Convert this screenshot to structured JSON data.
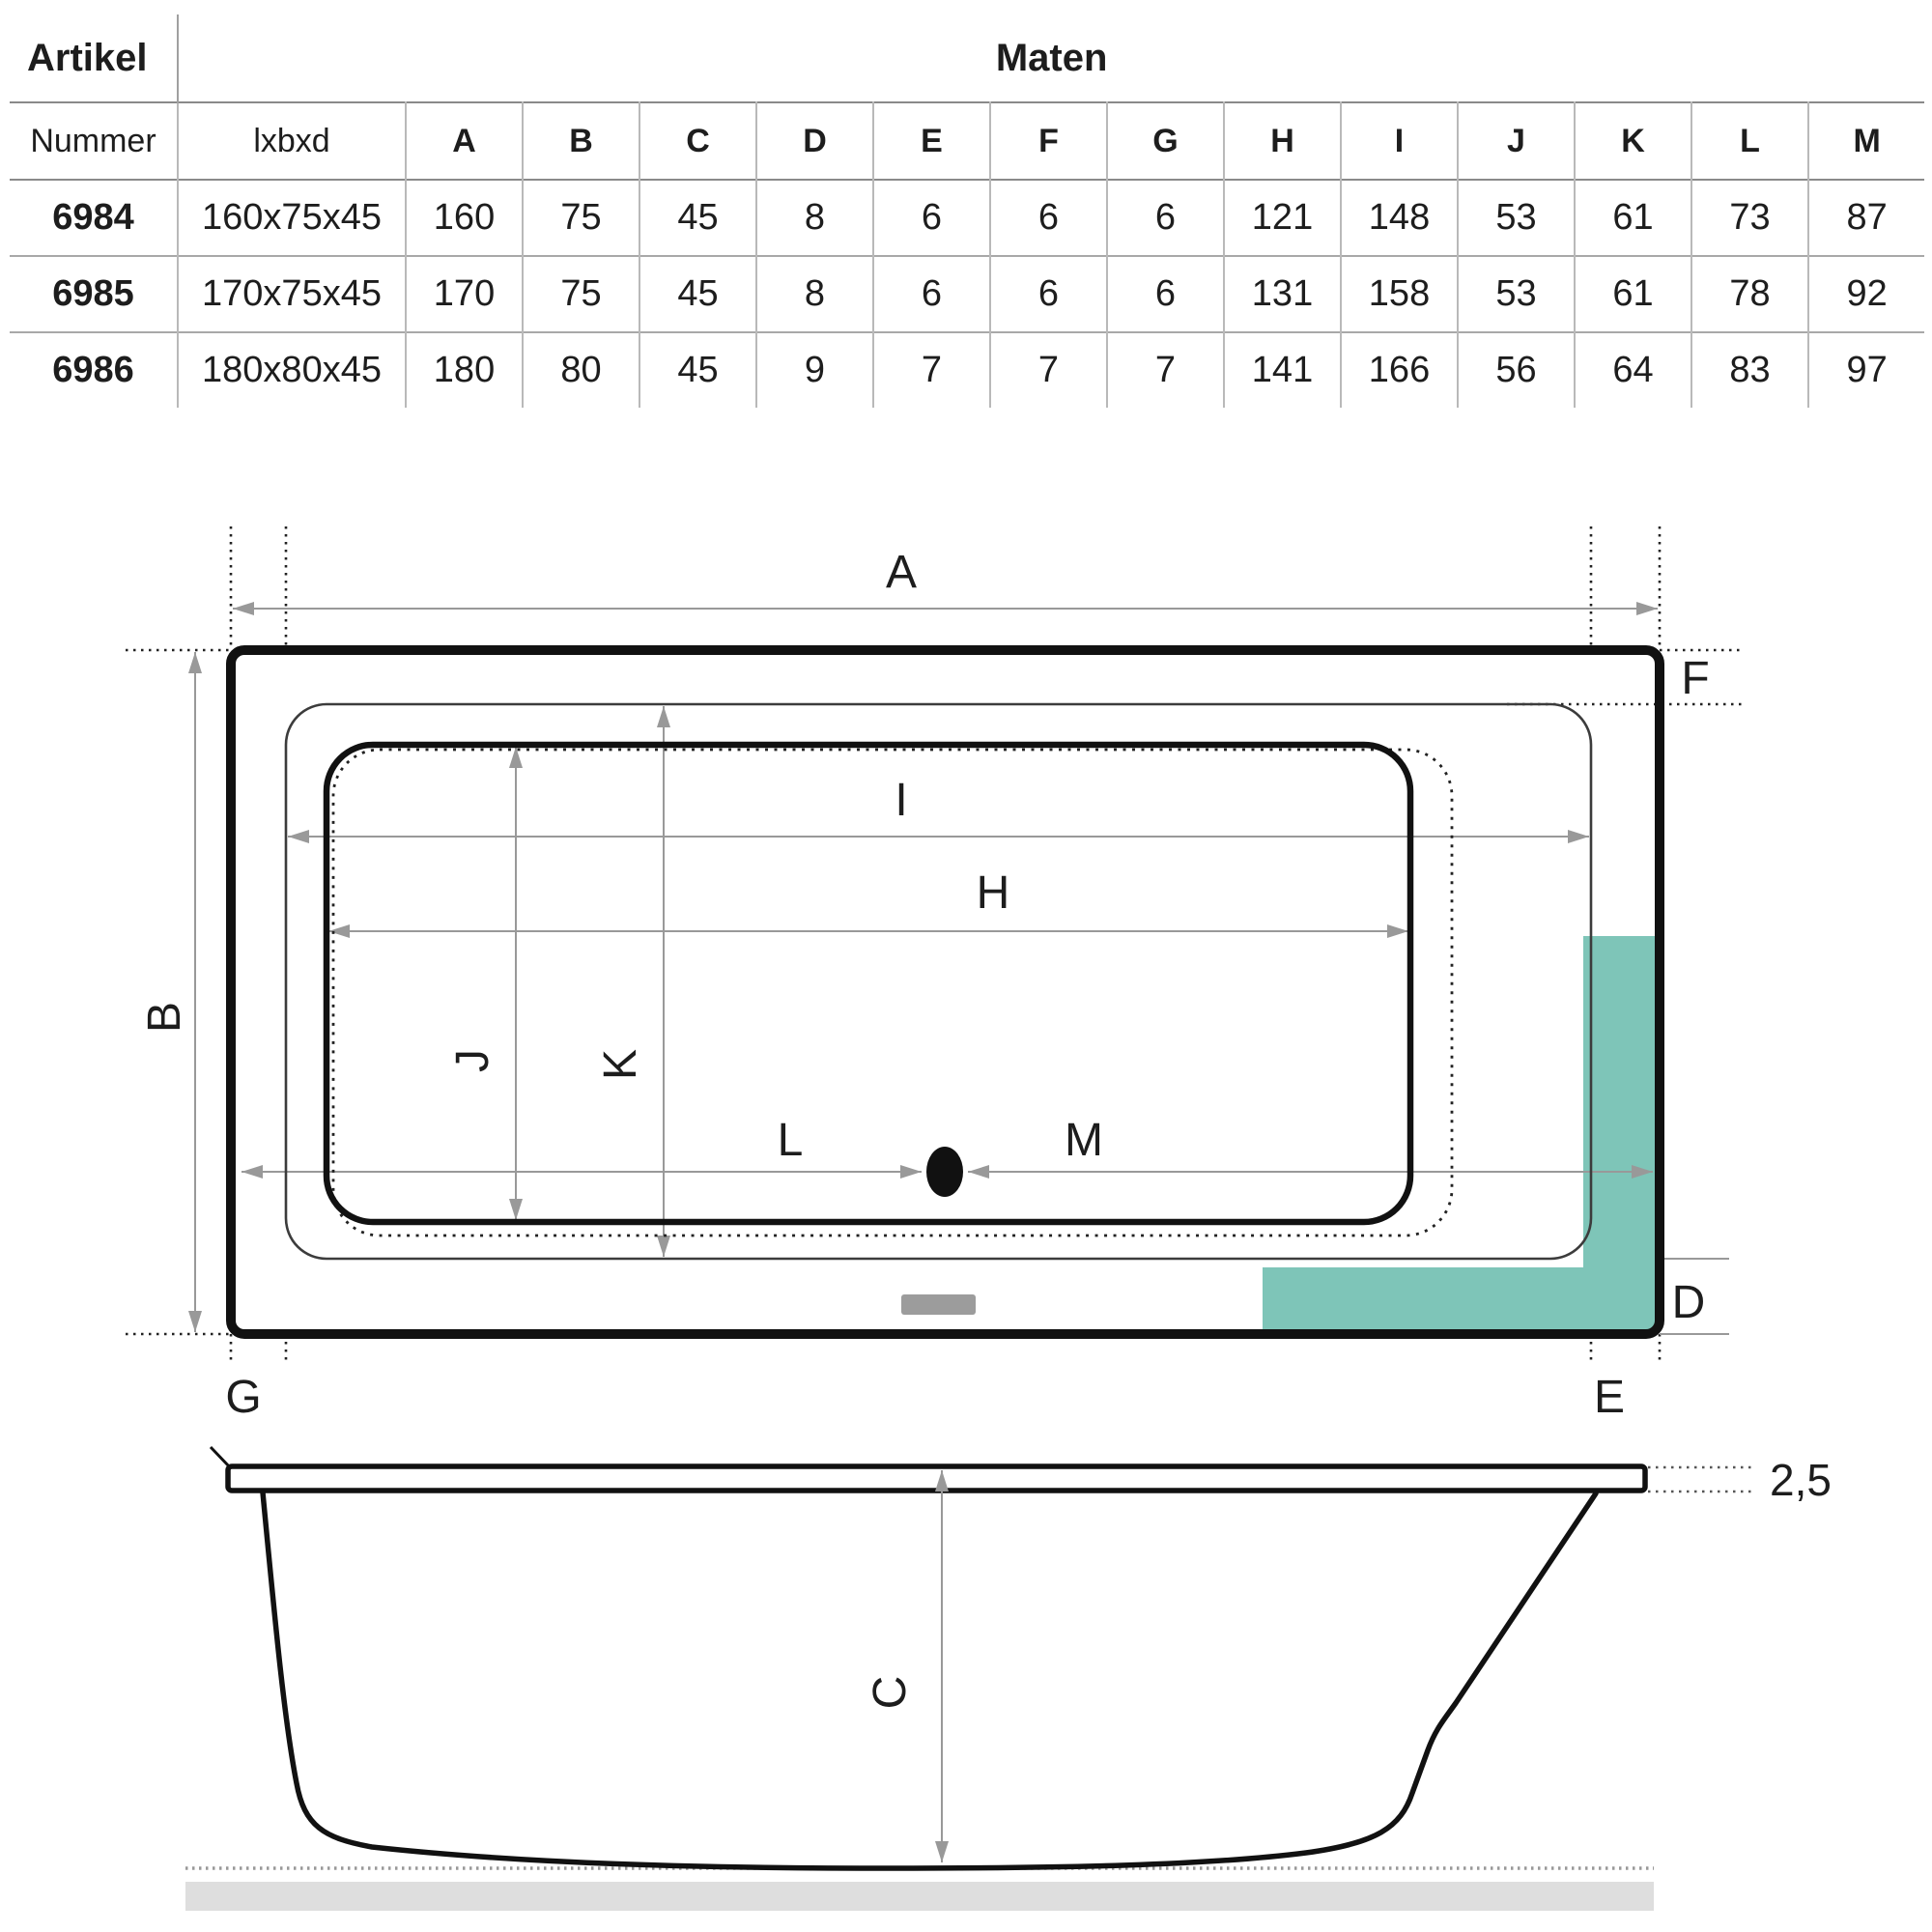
{
  "table": {
    "artikel_header": "Artikel",
    "maten_header": "Maten",
    "col_headers": [
      "Nummer",
      "lxbxd",
      "A",
      "B",
      "C",
      "D",
      "E",
      "F",
      "G",
      "H",
      "I",
      "J",
      "K",
      "L",
      "M"
    ],
    "rows": [
      {
        "nummer": "6984",
        "lxbxd": "160x75x45",
        "values": [
          "160",
          "75",
          "45",
          "8",
          "6",
          "6",
          "6",
          "121",
          "148",
          "53",
          "61",
          "73",
          "87"
        ]
      },
      {
        "nummer": "6985",
        "lxbxd": "170x75x45",
        "values": [
          "170",
          "75",
          "45",
          "8",
          "6",
          "6",
          "6",
          "131",
          "158",
          "53",
          "61",
          "78",
          "92"
        ]
      },
      {
        "nummer": "6986",
        "lxbxd": "180x80x45",
        "values": [
          "180",
          "80",
          "45",
          "9",
          "7",
          "7",
          "7",
          "141",
          "166",
          "56",
          "64",
          "83",
          "97"
        ]
      }
    ]
  },
  "top_view": {
    "labels": {
      "A": "A",
      "B": "B",
      "D": "D",
      "E": "E",
      "F": "F",
      "G": "G",
      "H": "H",
      "I": "I",
      "J": "J",
      "K": "K",
      "L": "L",
      "M": "M"
    }
  },
  "side_view": {
    "labels": {
      "C": "C",
      "rim_thickness": "2,5"
    }
  },
  "colors": {
    "teal_highlight": "#7ec5b8",
    "line": "#111111",
    "dim_line": "#999999",
    "overflow_slot": "#9c9c9c",
    "ground_shadow": "#dedede"
  }
}
